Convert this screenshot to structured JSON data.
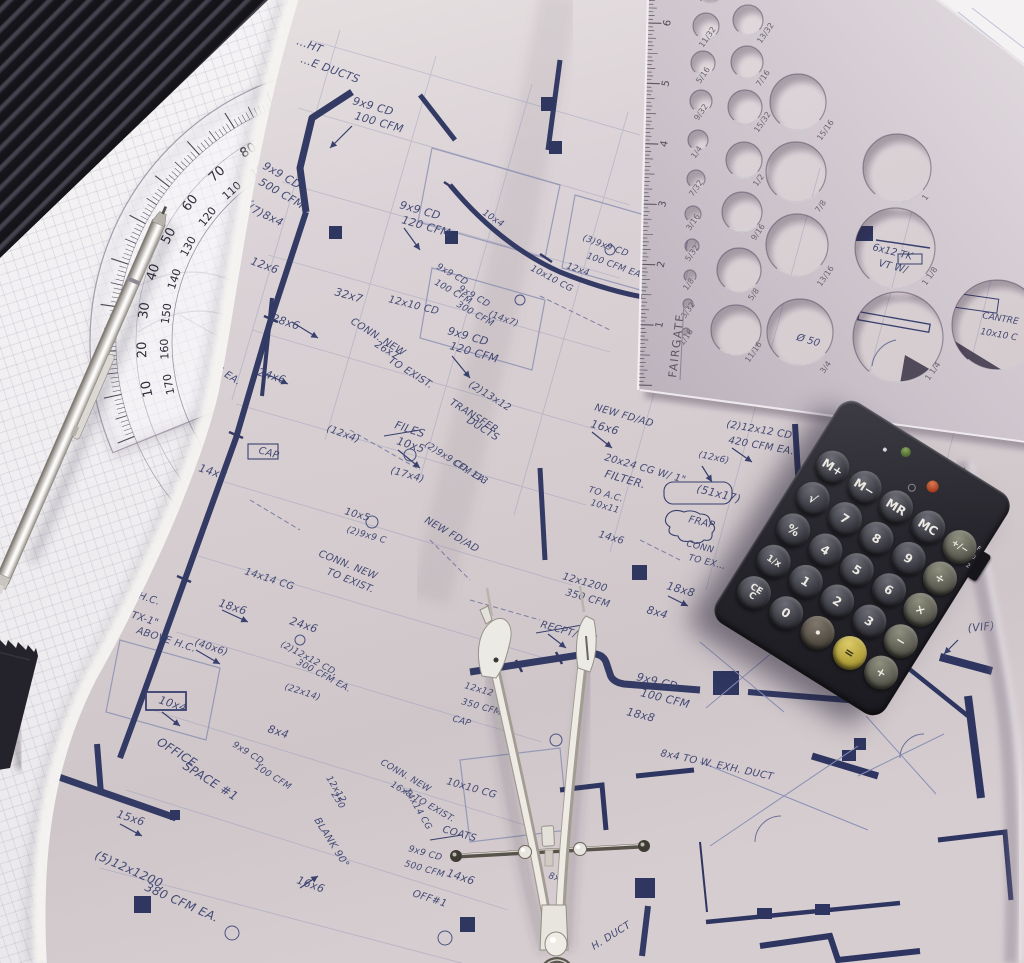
{
  "colors": {
    "blueprint_ink": "#39406e",
    "blueprint_duct": "#333a64",
    "blueprint_print": "#7d84ad",
    "page_paper": "#d8d0d4",
    "graph_paper": "#f0eef0",
    "template_metal": "#cdc4cc",
    "calculator_body": "#26252c",
    "equals_key_yellow": "#b3a23c",
    "metal_tool": "#ece9e2"
  },
  "protractor": {
    "outer_labels": [
      "90",
      "80",
      "70",
      "60",
      "50",
      "40",
      "30",
      "20",
      "10"
    ],
    "inner_labels": [
      "100",
      "110",
      "120",
      "130",
      "140",
      "150",
      "160",
      "170"
    ]
  },
  "template": {
    "brand": "FAIRGATE",
    "ruler_numbers": [
      "1",
      "2",
      "3",
      "4",
      "5",
      "6"
    ],
    "holes": [
      {
        "f": "1/16",
        "cx": 686,
        "cy": 332,
        "r": 4,
        "lx": 683,
        "ly": 346
      },
      {
        "f": "3/32",
        "cx": 688,
        "cy": 304,
        "r": 5,
        "lx": 685,
        "ly": 319
      },
      {
        "f": "1/8",
        "cx": 690,
        "cy": 276,
        "r": 6,
        "lx": 687,
        "ly": 291
      },
      {
        "f": "5/32",
        "cx": 692,
        "cy": 246,
        "r": 7,
        "lx": 689,
        "ly": 262
      },
      {
        "f": "3/16",
        "cx": 693,
        "cy": 214,
        "r": 8,
        "lx": 690,
        "ly": 231
      },
      {
        "f": "7/32",
        "cx": 696,
        "cy": 179,
        "r": 9,
        "lx": 693,
        "ly": 197
      },
      {
        "f": "1/4",
        "cx": 698,
        "cy": 140,
        "r": 10,
        "lx": 695,
        "ly": 159
      },
      {
        "f": "9/32",
        "cx": 701,
        "cy": 101,
        "r": 11,
        "lx": 698,
        "ly": 121
      },
      {
        "f": "5/16",
        "cx": 703,
        "cy": 63,
        "r": 12,
        "lx": 700,
        "ly": 84
      },
      {
        "f": "11/32",
        "cx": 706,
        "cy": 26,
        "r": 13,
        "lx": 703,
        "ly": 48
      },
      {
        "f": "",
        "cx": 710,
        "cy": -9,
        "r": 13,
        "lx": 0,
        "ly": 0
      },
      {
        "f": "13/32",
        "cx": 748,
        "cy": 20,
        "r": 15,
        "lx": 761,
        "ly": 44
      },
      {
        "f": "7/16",
        "cx": 747,
        "cy": 62,
        "r": 16,
        "lx": 760,
        "ly": 87
      },
      {
        "f": "15/32",
        "cx": 745,
        "cy": 107,
        "r": 17,
        "lx": 758,
        "ly": 133
      },
      {
        "f": "1/2",
        "cx": 744,
        "cy": 160,
        "r": 18,
        "lx": 757,
        "ly": 187
      },
      {
        "f": "9/16",
        "cx": 742,
        "cy": 212,
        "r": 20,
        "lx": 755,
        "ly": 241
      },
      {
        "f": "5/8",
        "cx": 739,
        "cy": 270,
        "r": 22,
        "lx": 752,
        "ly": 301
      },
      {
        "f": "11/16",
        "cx": 736,
        "cy": 330,
        "r": 25,
        "lx": 749,
        "ly": 363
      },
      {
        "f": "15/16",
        "cx": 798,
        "cy": 102,
        "r": 28,
        "lx": 821,
        "ly": 141
      },
      {
        "f": "7/8",
        "cx": 796,
        "cy": 172,
        "r": 30,
        "lx": 819,
        "ly": 213
      },
      {
        "f": "13/16",
        "cx": 797,
        "cy": 245,
        "r": 31,
        "lx": 821,
        "ly": 287
      },
      {
        "f": "3/4",
        "cx": 800,
        "cy": 332,
        "r": 33,
        "lx": 824,
        "ly": 374
      },
      {
        "f": "1",
        "cx": 897,
        "cy": 168,
        "r": 34,
        "lx": 926,
        "ly": 201
      },
      {
        "f": "1 1/8",
        "cx": 895,
        "cy": 248,
        "r": 40,
        "lx": 926,
        "ly": 286
      },
      {
        "f": "1 1/4",
        "cx": 898,
        "cy": 337,
        "r": 45,
        "lx": 929,
        "ly": 381
      },
      {
        "f": "",
        "cx": 997,
        "cy": 325,
        "r": 45,
        "lx": 0,
        "ly": 0
      }
    ]
  },
  "calculator": {
    "rows": [
      [
        "M+",
        "M−",
        "MR",
        "MC",
        "+/−"
      ],
      [
        "√",
        "7",
        "8",
        "9",
        "÷"
      ],
      [
        "%",
        "4",
        "5",
        "6",
        "×"
      ],
      [
        "1/x",
        "1",
        "2",
        "3",
        "−"
      ],
      [
        "CE\nC",
        "0",
        "•",
        "=",
        "+"
      ]
    ],
    "switch_labels": [
      "F",
      "0",
      "2"
    ]
  },
  "blueprint": {
    "annotations": [
      {
        "t": "…HT",
        "x": 296,
        "y": 44,
        "r": 20
      },
      {
        "t": "…E DUCTS",
        "x": 300,
        "y": 62,
        "r": 20
      },
      {
        "t": "9x9 CD",
        "x": 352,
        "y": 104,
        "r": 16
      },
      {
        "t": "100 CFM",
        "x": 354,
        "y": 119,
        "r": 16
      },
      {
        "t": "9x9 CD",
        "x": 262,
        "y": 168,
        "r": 30
      },
      {
        "t": "500 CFM",
        "x": 258,
        "y": 184,
        "r": 30
      },
      {
        "t": "(7)8x4",
        "x": 247,
        "y": 210,
        "r": 26
      },
      {
        "t": "12x6",
        "x": 250,
        "y": 264,
        "r": 20
      },
      {
        "t": "28x6",
        "x": 271,
        "y": 321,
        "r": 18
      },
      {
        "t": "24x6",
        "x": 257,
        "y": 375,
        "r": 18
      },
      {
        "t": "9x9 CD",
        "x": 399,
        "y": 208,
        "r": 16
      },
      {
        "t": "120 CFM",
        "x": 401,
        "y": 223,
        "r": 16
      },
      {
        "t": "32x7",
        "x": 334,
        "y": 295,
        "r": 16
      },
      {
        "t": "12x10 CD",
        "x": 388,
        "y": 302,
        "r": 14,
        "s": 10
      },
      {
        "t": "CONN. NEW",
        "x": 350,
        "y": 323,
        "r": 32,
        "s": 10
      },
      {
        "t": "26x7",
        "x": 374,
        "y": 346,
        "r": 32,
        "s": 10
      },
      {
        "t": "TO EXIST.",
        "x": 388,
        "y": 362,
        "r": 32,
        "s": 10
      },
      {
        "t": "9x9 CD",
        "x": 447,
        "y": 334,
        "r": 16
      },
      {
        "t": "120 CFM",
        "x": 449,
        "y": 349,
        "r": 16
      },
      {
        "t": "(2)13x12",
        "x": 468,
        "y": 386,
        "r": 32,
        "s": 10
      },
      {
        "t": "TRANSFER",
        "x": 449,
        "y": 404,
        "r": 32,
        "s": 10
      },
      {
        "t": "DUCTS",
        "x": 466,
        "y": 422,
        "r": 32,
        "s": 10
      },
      {
        "t": "(2)9x9 CD, 113",
        "x": 424,
        "y": 446,
        "r": 32,
        "s": 9
      },
      {
        "t": "CFM EA.",
        "x": 452,
        "y": 464,
        "r": 32,
        "s": 9
      },
      {
        "t": "FILES",
        "x": 394,
        "y": 428,
        "r": 18
      },
      {
        "t": "10x5",
        "x": 396,
        "y": 444,
        "r": 18
      },
      {
        "t": "(12x4)",
        "x": 326,
        "y": 431,
        "r": 20,
        "s": 10
      },
      {
        "t": "(17x4)",
        "x": 390,
        "y": 473,
        "r": 16,
        "s": 10
      },
      {
        "t": "NEW FD/AD",
        "x": 424,
        "y": 522,
        "r": 30,
        "s": 10
      },
      {
        "t": "12x1600",
        "x": 126,
        "y": 506,
        "r": 32,
        "s": 10
      },
      {
        "t": "CFM",
        "x": 130,
        "y": 522,
        "r": 32,
        "s": 10
      },
      {
        "t": "9x9 CD",
        "x": 188,
        "y": 334,
        "r": 32,
        "s": 10
      },
      {
        "t": "100 CFM EA.",
        "x": 182,
        "y": 350,
        "r": 32,
        "s": 10
      },
      {
        "t": "14x6",
        "x": 198,
        "y": 471,
        "r": 18
      },
      {
        "t": "CAP",
        "x": 258,
        "y": 453,
        "r": 16,
        "s": 10
      },
      {
        "t": "10x5",
        "x": 344,
        "y": 514,
        "r": 16,
        "s": 10
      },
      {
        "t": "(2)9x9 C",
        "x": 346,
        "y": 532,
        "r": 16,
        "s": 9
      },
      {
        "t": "CONN. NEW",
        "x": 318,
        "y": 556,
        "r": 22,
        "s": 10
      },
      {
        "t": "TO EXIST.",
        "x": 326,
        "y": 574,
        "r": 22,
        "s": 10
      },
      {
        "t": "ABOVE H.C.",
        "x": 100,
        "y": 586,
        "r": 18,
        "s": 10
      },
      {
        "t": "14x14 CG",
        "x": 244,
        "y": 574,
        "r": 18,
        "s": 10
      },
      {
        "t": "18x6",
        "x": 218,
        "y": 606,
        "r": 18
      },
      {
        "t": "\"TX-1\"",
        "x": 126,
        "y": 616,
        "r": 18,
        "s": 10
      },
      {
        "t": "ABOVE H.C.",
        "x": 136,
        "y": 633,
        "r": 18,
        "s": 10
      },
      {
        "t": "(40x6)",
        "x": 194,
        "y": 645,
        "r": 18,
        "s": 10
      },
      {
        "t": "24x6",
        "x": 289,
        "y": 624,
        "r": 18
      },
      {
        "t": "(2)12x12 CD,",
        "x": 280,
        "y": 646,
        "r": 28,
        "s": 9
      },
      {
        "t": "300 CFM EA.",
        "x": 296,
        "y": 664,
        "r": 28,
        "s": 9
      },
      {
        "t": "(22x14)",
        "x": 284,
        "y": 689,
        "r": 18,
        "s": 9
      },
      {
        "t": "10x4",
        "x": 158,
        "y": 703,
        "r": 18
      },
      {
        "t": "8x4",
        "x": 267,
        "y": 732,
        "r": 18
      },
      {
        "t": "OFFICE",
        "x": 156,
        "y": 744,
        "r": 32,
        "s": 12
      },
      {
        "t": "SPACE #1",
        "x": 182,
        "y": 768,
        "r": 32,
        "s": 12
      },
      {
        "t": "9x9 CD,",
        "x": 232,
        "y": 746,
        "r": 32,
        "s": 9
      },
      {
        "t": "100 CFM",
        "x": 254,
        "y": 768,
        "r": 32,
        "s": 9
      },
      {
        "t": "15x6",
        "x": 116,
        "y": 817,
        "r": 18
      },
      {
        "t": "(5)12x1200,",
        "x": 94,
        "y": 858,
        "r": 24,
        "s": 12
      },
      {
        "t": "380 CFM EA.",
        "x": 144,
        "y": 890,
        "r": 24,
        "s": 12
      },
      {
        "t": "BLANK 90°",
        "x": 314,
        "y": 820,
        "r": 58,
        "s": 10
      },
      {
        "t": "16x6",
        "x": 296,
        "y": 883,
        "r": 20
      },
      {
        "t": "12x12",
        "x": 326,
        "y": 778,
        "r": 58,
        "s": 9
      },
      {
        "t": "250",
        "x": 331,
        "y": 794,
        "r": 58,
        "s": 9
      },
      {
        "t": "NEW FD/AD",
        "x": 594,
        "y": 410,
        "r": 16,
        "s": 10
      },
      {
        "t": "16x6",
        "x": 590,
        "y": 427,
        "r": 16
      },
      {
        "t": "20x24 CG W/ 1\"",
        "x": 604,
        "y": 460,
        "r": 16,
        "s": 10
      },
      {
        "t": "FILTER.",
        "x": 604,
        "y": 477,
        "r": 16
      },
      {
        "t": "TO A.C.",
        "x": 588,
        "y": 492,
        "r": 16,
        "s": 9
      },
      {
        "t": "10x11",
        "x": 590,
        "y": 505,
        "r": 16,
        "s": 9
      },
      {
        "t": "(51x17)",
        "x": 696,
        "y": 492,
        "r": 14
      },
      {
        "t": "FRAP",
        "x": 688,
        "y": 522,
        "r": 14,
        "s": 10
      },
      {
        "t": "CONN",
        "x": 686,
        "y": 546,
        "r": 14,
        "s": 9
      },
      {
        "t": "TO EX…",
        "x": 688,
        "y": 560,
        "r": 14,
        "s": 9
      },
      {
        "t": "18x8",
        "x": 666,
        "y": 589,
        "r": 16
      },
      {
        "t": "8x4",
        "x": 646,
        "y": 613,
        "r": 16
      },
      {
        "t": "14x6",
        "x": 598,
        "y": 537,
        "r": 16,
        "s": 10
      },
      {
        "t": "12x1200",
        "x": 562,
        "y": 579,
        "r": 16,
        "s": 10
      },
      {
        "t": "350 CFM",
        "x": 565,
        "y": 595,
        "r": 16,
        "s": 10
      },
      {
        "t": "RECPT/CLK",
        "x": 540,
        "y": 627,
        "r": 16,
        "s": 10
      },
      {
        "t": "(2)12x12 CD",
        "x": 726,
        "y": 427,
        "r": 10,
        "s": 10
      },
      {
        "t": "420 CFM EA.",
        "x": 728,
        "y": 443,
        "r": 10,
        "s": 10
      },
      {
        "t": "(12x6)",
        "x": 698,
        "y": 457,
        "r": 12,
        "s": 9
      },
      {
        "t": "…E. MAKE",
        "x": 700,
        "y": 393,
        "r": 8,
        "s": 9
      },
      {
        "t": "5 1/2x6",
        "x": 788,
        "y": 404,
        "r": 8,
        "s": 10
      },
      {
        "t": "9x9 CD",
        "x": 636,
        "y": 680,
        "r": 14
      },
      {
        "t": "100 CFM",
        "x": 640,
        "y": 696,
        "r": 14
      },
      {
        "t": "18x8",
        "x": 626,
        "y": 715,
        "r": 14
      },
      {
        "t": "8x4 TO W. EXH. DUCT",
        "x": 660,
        "y": 756,
        "r": 12,
        "s": 10
      },
      {
        "t": "12x12",
        "x": 464,
        "y": 688,
        "r": 16,
        "s": 9
      },
      {
        "t": "350 CFM",
        "x": 461,
        "y": 704,
        "r": 16,
        "s": 9
      },
      {
        "t": "CAP",
        "x": 452,
        "y": 721,
        "r": 16,
        "s": 9
      },
      {
        "t": "10x10 CG",
        "x": 446,
        "y": 784,
        "r": 16,
        "s": 10
      },
      {
        "t": "14x14 CG",
        "x": 404,
        "y": 790,
        "r": 60,
        "s": 9
      },
      {
        "t": "COATS",
        "x": 442,
        "y": 832,
        "r": 16,
        "s": 10
      },
      {
        "t": "9x9 CD",
        "x": 408,
        "y": 851,
        "r": 16,
        "s": 9
      },
      {
        "t": "500 CFM",
        "x": 404,
        "y": 866,
        "r": 16,
        "s": 9
      },
      {
        "t": "14x6",
        "x": 446,
        "y": 876,
        "r": 18
      },
      {
        "t": "OFF#1",
        "x": 412,
        "y": 896,
        "r": 18,
        "s": 10
      },
      {
        "t": "(VIF)",
        "x": 968,
        "y": 632,
        "r": -6
      },
      {
        "t": "CONN. NEW",
        "x": 380,
        "y": 764,
        "r": 30,
        "s": 9
      },
      {
        "t": "16x8 TO EXIST.",
        "x": 390,
        "y": 786,
        "r": 30,
        "s": 9
      },
      {
        "t": "H. DUCT",
        "x": 594,
        "y": 950,
        "r": -32,
        "s": 10
      },
      {
        "t": "8x4",
        "x": 548,
        "y": 878,
        "r": 16,
        "s": 9
      },
      {
        "t": "10x4",
        "x": 482,
        "y": 214,
        "r": 34,
        "s": 9
      },
      {
        "t": "10x10 CG",
        "x": 530,
        "y": 270,
        "r": 28,
        "s": 9
      },
      {
        "t": "(3)9x9 CD",
        "x": 582,
        "y": 240,
        "r": 20,
        "s": 9
      },
      {
        "t": "100 CFM EA",
        "x": 586,
        "y": 258,
        "r": 20,
        "s": 9
      },
      {
        "t": "12x4",
        "x": 566,
        "y": 268,
        "r": 20,
        "s": 9
      },
      {
        "t": "9x9 CD",
        "x": 436,
        "y": 268,
        "r": 30,
        "s": 9
      },
      {
        "t": "100 CFM",
        "x": 434,
        "y": 284,
        "r": 30,
        "s": 9
      },
      {
        "t": "9x9 CD",
        "x": 458,
        "y": 290,
        "r": 30,
        "s": 9
      },
      {
        "t": "300 CFM",
        "x": 456,
        "y": 306,
        "r": 30,
        "s": 9
      },
      {
        "t": "(14x7)",
        "x": 488,
        "y": 316,
        "r": 20,
        "s": 9
      }
    ],
    "under_template_notes": [
      {
        "t": "6x12 TK",
        "x": 872,
        "y": 250,
        "r": 14,
        "s": 10
      },
      {
        "t": "VT W/",
        "x": 878,
        "y": 266,
        "r": 14,
        "s": 10
      },
      {
        "t": "CANTRE",
        "x": 982,
        "y": 318,
        "r": 10,
        "s": 9
      },
      {
        "t": "10x10 C",
        "x": 980,
        "y": 334,
        "r": 10,
        "s": 9
      },
      {
        "t": "Ø 50",
        "x": 796,
        "y": 340,
        "r": 16,
        "s": 10
      }
    ]
  }
}
